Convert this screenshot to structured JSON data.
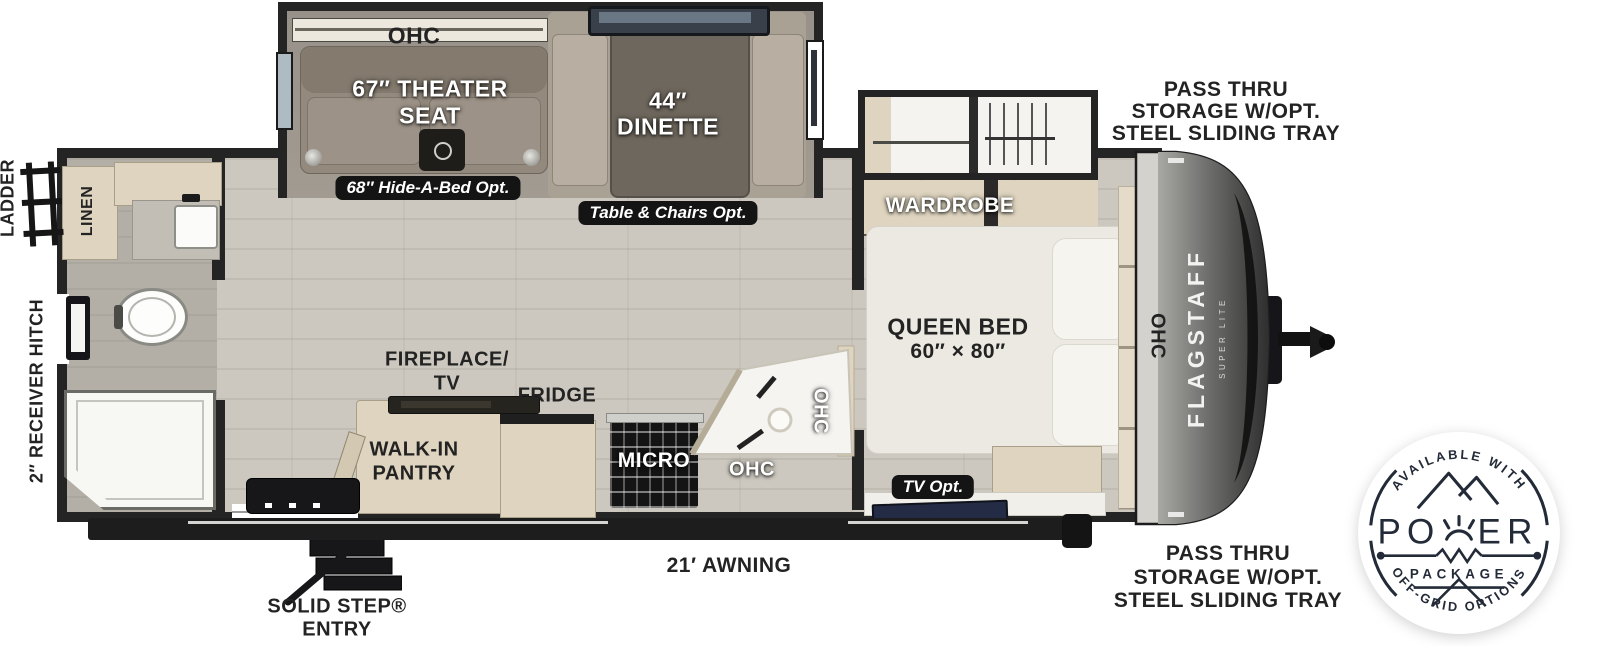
{
  "title": "Flagstaff Super Lite travel trailer floor plan",
  "labels": {
    "ohc_top": "OHC",
    "theater1": "67″ THEATER",
    "theater2": "SEAT",
    "dinette1": "44″",
    "dinette2": "DINETTE",
    "hide_a_bed": "68″ Hide-A-Bed Opt.",
    "table_chairs": "Table & Chairs Opt.",
    "pass_thru1": "PASS THRU",
    "pass_thru2": "STORAGE W/OPT.",
    "pass_thru3": "STEEL SLIDING TRAY",
    "wardrobe": "WARDROBE",
    "queen1": "QUEEN BED",
    "queen2": "60″ × 80″",
    "ohc_bed": "OHC",
    "ladder": "LADDER",
    "receiver_hitch": "2″ RECEIVER HITCH",
    "linen": "LINEN",
    "fireplace1": "FIREPLACE/",
    "fireplace2": "TV",
    "fridge": "FRIDGE",
    "pantry1": "WALK-IN",
    "pantry2": "PANTRY",
    "micro": "MICRO",
    "ohc_kitchen": "OHC",
    "ohc_kitchen_v": "OHC",
    "tv_opt": "TV Opt.",
    "awning": "21′ AWNING",
    "solid_step1": "SOLID STEP®",
    "solid_step2": "ENTRY"
  },
  "brand": {
    "name": "FLAGSTAFF",
    "sub": "SUPER LITE"
  },
  "power_badge": {
    "top": "AVAILABLE WITH",
    "po": "PO",
    "er": "ER",
    "package": "PACKAGE",
    "bottom": "OFF-GRID OPTIONS"
  },
  "colors": {
    "wall": "#242424",
    "floor": "#ccc8bf",
    "slide-floor": "#9d978d",
    "wood": "#ded4bf",
    "badge-bg": "#141414",
    "text-dark": "#232323",
    "tv-screen": "#232c44",
    "counter": "#f5f4f0",
    "badge-navy": "#242b38"
  }
}
